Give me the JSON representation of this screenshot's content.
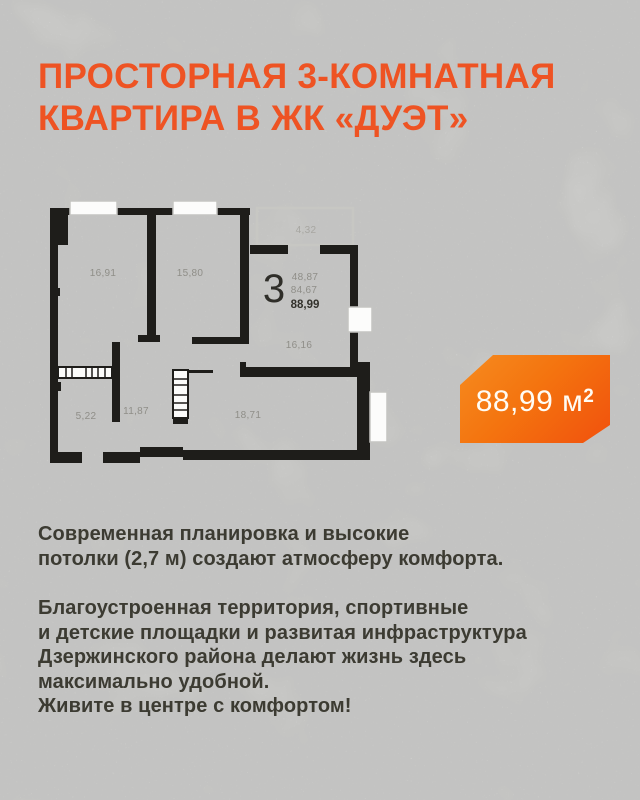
{
  "header": {
    "title": "ПРОСТОРНАЯ 3-КОМНАТНАЯ\nКВАРТИРА В ЖК «ДУЭТ»"
  },
  "floor_plan": {
    "room_count": "3",
    "labels": {
      "bedroom_1": "16,91",
      "bedroom_2": "15,80",
      "balcony": "4,32",
      "living_space": "48,87",
      "area_without_balcony": "84,67",
      "total_area": "88,99",
      "kitchen_living": "16,16",
      "bathroom": "5,22",
      "hallway": "11,87",
      "kitchen_dining": "18,71"
    }
  },
  "badge": {
    "area": "88,99 м",
    "superscript": "2"
  },
  "body": {
    "paragraph_1": "Современная планировка и высокие\nпотолки (2,7 м) создают атмосферу комфорта.",
    "paragraph_2": "Благоустроенная территория, спортивные\nи детские площадки и развитая инфраструктура\nДзержинского района делают жизнь здесь\nмаксимально удобной.\nЖивите в центре с комфортом!"
  },
  "colors": {
    "accent_orange": "#EE5323",
    "badge_gradient_start": "#F68B1F",
    "badge_gradient_end": "#F1510D",
    "text_dark": "#3C3B32",
    "wall_black": "#1E1D1A",
    "plan_label_gray": "#8F8E88"
  }
}
